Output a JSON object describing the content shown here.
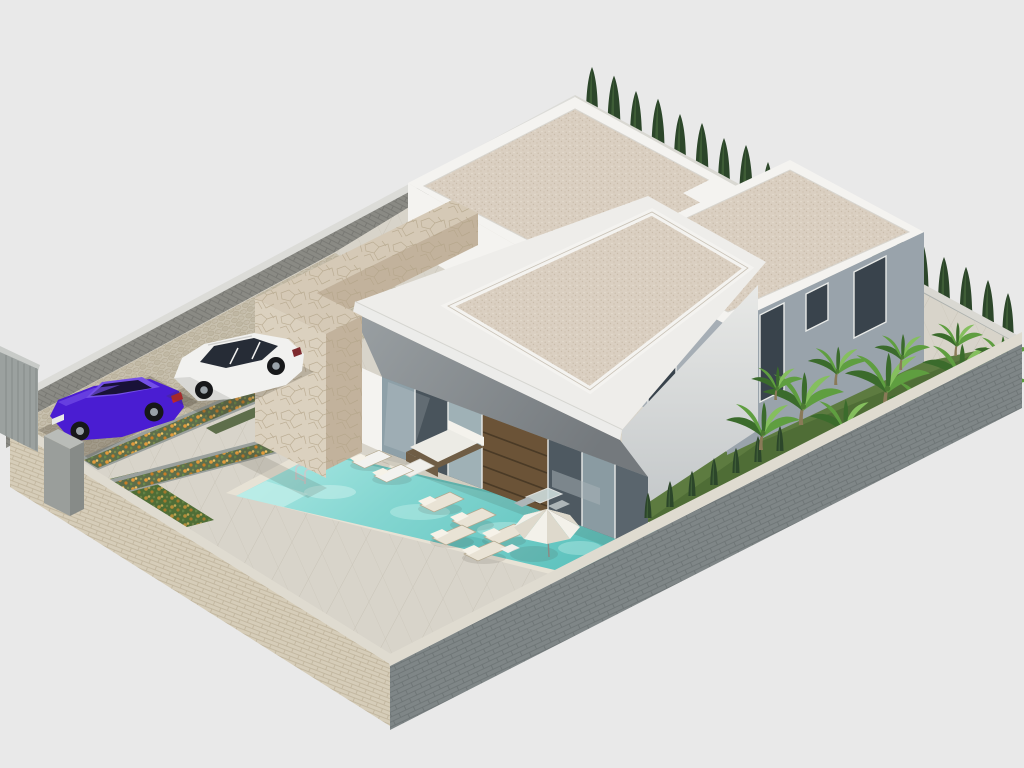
{
  "scene": {
    "kind": "3d-architectural-render",
    "view": "isometric aerial",
    "subject": "Modern single-storey villa plot with flat gravel roofs, stone entrance pylon, swimming pool, sun terrace, driveway with two parked cars, tropical garden and perimeter walls",
    "background": "plain light gray"
  },
  "objects": {
    "rear_block": "rear villa block with gravel flat roof",
    "side_block": "side villa block with gray walls and windows",
    "main_block": "main living block with cantilevered roof and glass facade",
    "stone_pylon": "travertine stone entrance pylon",
    "stone_parapet": "travertine parapet wall",
    "pool": "turquoise swimming pool with chrome ladder",
    "parasol": "white garden parasol",
    "sofa": "outdoor lounge sofa set",
    "loungers": "sun loungers",
    "bistro": "bistro table and chairs",
    "purple_car": "purple sedan car",
    "white_car": "white SUV car",
    "gate": "gray sliding entrance gate",
    "driveway": "cobblestone driveway",
    "flower_beds": "flower beds with orange blossoms",
    "palm_garden": "banana palm garden",
    "cypress_hedge": "cypress tree hedge",
    "walls": "brick perimeter walls"
  },
  "counts": {
    "cars": 2,
    "roof_volumes": 3,
    "sun_loungers": 7,
    "parasols": 1,
    "pool_ladders": 1
  },
  "palette": {
    "bg": "#e9e9e9",
    "white_lit": "#f4f3f0",
    "white_shade": "#e6e5e1",
    "slab_white": "#eeedea",
    "soffit": "#8d9195",
    "b_sw": "#a6aeb5",
    "b_se": "#99a3ab",
    "window_dark": "#39434c",
    "stone_light": "#dbd1bf",
    "stone_dark": "#c2b29c",
    "stone_top": "#d5c9b6",
    "glass_dark": "#57626b",
    "glass_mid": "#8ea0a8",
    "glass_light": "#b3c2c6",
    "wood_door": "#6b5337",
    "brick_gray": "#7f8687",
    "brick_beige": "#d6cdb9",
    "cap_light": "#dfdbd0",
    "deck": "#d8d4ca",
    "cobble": "#c8c1af",
    "grass": "#4f6d36",
    "grass_light": "#6b8a4a",
    "cypress": "#2c462a",
    "cypress_light": "#44633a",
    "palm_green": "#5f9e40",
    "palm_light": "#85bf5e",
    "palm_dark": "#3b6b2c",
    "planter_green": "#5e6e4b",
    "flower_orange": "#e29b3d",
    "water_light": "#ace7e2",
    "water_mid": "#7fd2cd",
    "water_deep": "#5abfba",
    "coping": "#e7e2d5",
    "car_purple": "#4a1dd2",
    "car_purple_hi": "#7450e8",
    "car_white": "#f1f1ef",
    "car_window": "#262c36",
    "wheel_dark": "#17181a",
    "rim": "#9aa2a8",
    "metal": "#c3c9cc",
    "umbrella": "#f3f1ea",
    "umbrella_shade": "#ded9cc",
    "lounger": "#e9e3d5",
    "sofa_base": "#6f5d45",
    "shadow": "#3f3a2e"
  }
}
